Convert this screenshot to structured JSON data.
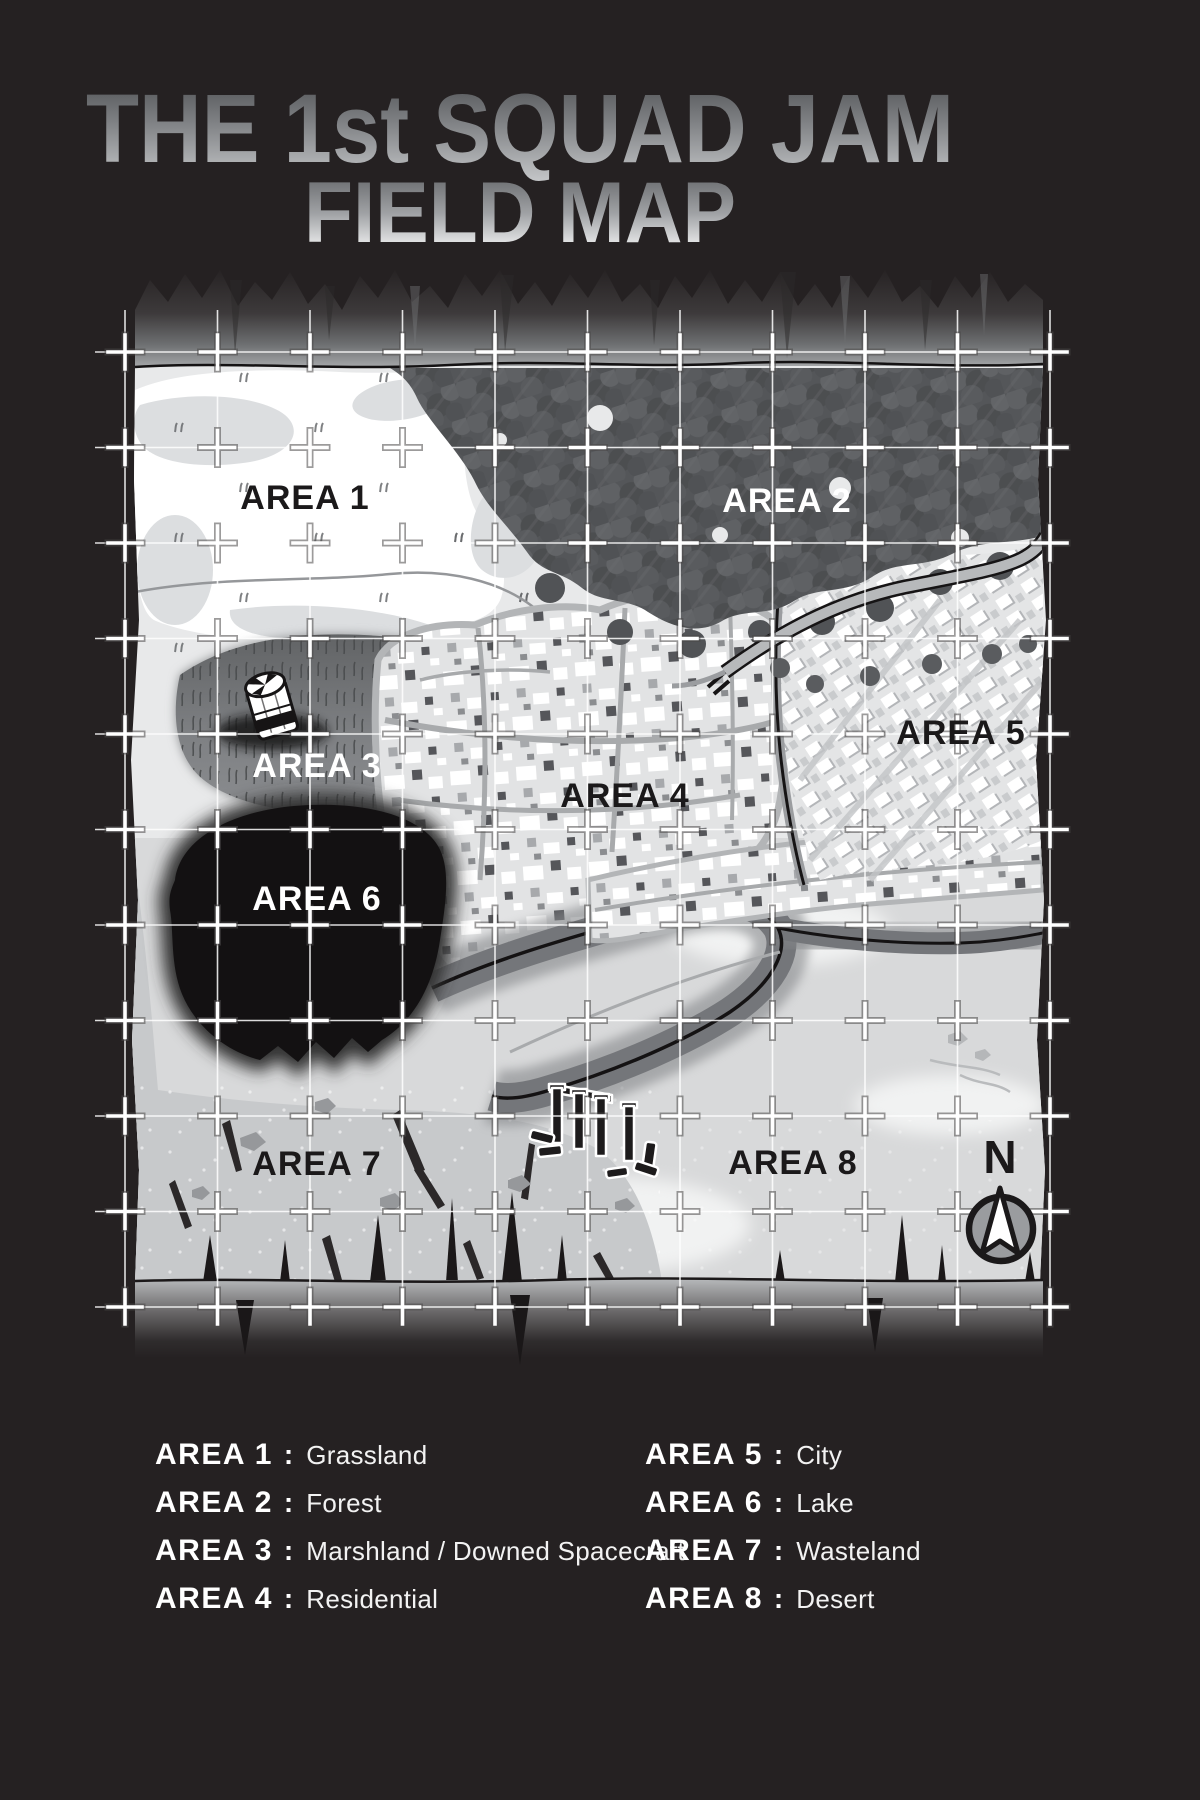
{
  "page": {
    "background_color": "#252122"
  },
  "title": {
    "line1": "THE 1st SQUAD JAM",
    "line2": "FIELD MAP"
  },
  "map": {
    "compass_label": "N",
    "labels": [
      {
        "text": "AREA 1"
      },
      {
        "text": "AREA 2"
      },
      {
        "text": "AREA 3"
      },
      {
        "text": "AREA 4"
      },
      {
        "text": "AREA 5"
      },
      {
        "text": "AREA 6"
      },
      {
        "text": "AREA 7"
      },
      {
        "text": "AREA 8"
      }
    ],
    "icons": [
      {
        "name": "downed-spacecraft-icon"
      },
      {
        "name": "ruins-icon"
      },
      {
        "name": "compass-icon"
      }
    ],
    "palette": {
      "background": "#252122",
      "paper": "#e8e9ea",
      "grassland": "#ffffff",
      "forest": "#56585b",
      "marsh": "#7e8083",
      "lake": "#131112",
      "residential": "#e2e3e4",
      "city": "#e4e5e6",
      "wasteland": "#c7c9cb",
      "desert": "#d8d9da",
      "grid": "#ffffff"
    }
  },
  "legend": {
    "separator": ":",
    "items": [
      {
        "area": "AREA 1",
        "terrain": "Grassland"
      },
      {
        "area": "AREA 2",
        "terrain": "Forest"
      },
      {
        "area": "AREA 3",
        "terrain": "Marshland / Downed Spacecraft"
      },
      {
        "area": "AREA 4",
        "terrain": "Residential"
      },
      {
        "area": "AREA 5",
        "terrain": "City"
      },
      {
        "area": "AREA 6",
        "terrain": "Lake"
      },
      {
        "area": "AREA 7",
        "terrain": "Wasteland"
      },
      {
        "area": "AREA 8",
        "terrain": "Desert"
      }
    ]
  }
}
